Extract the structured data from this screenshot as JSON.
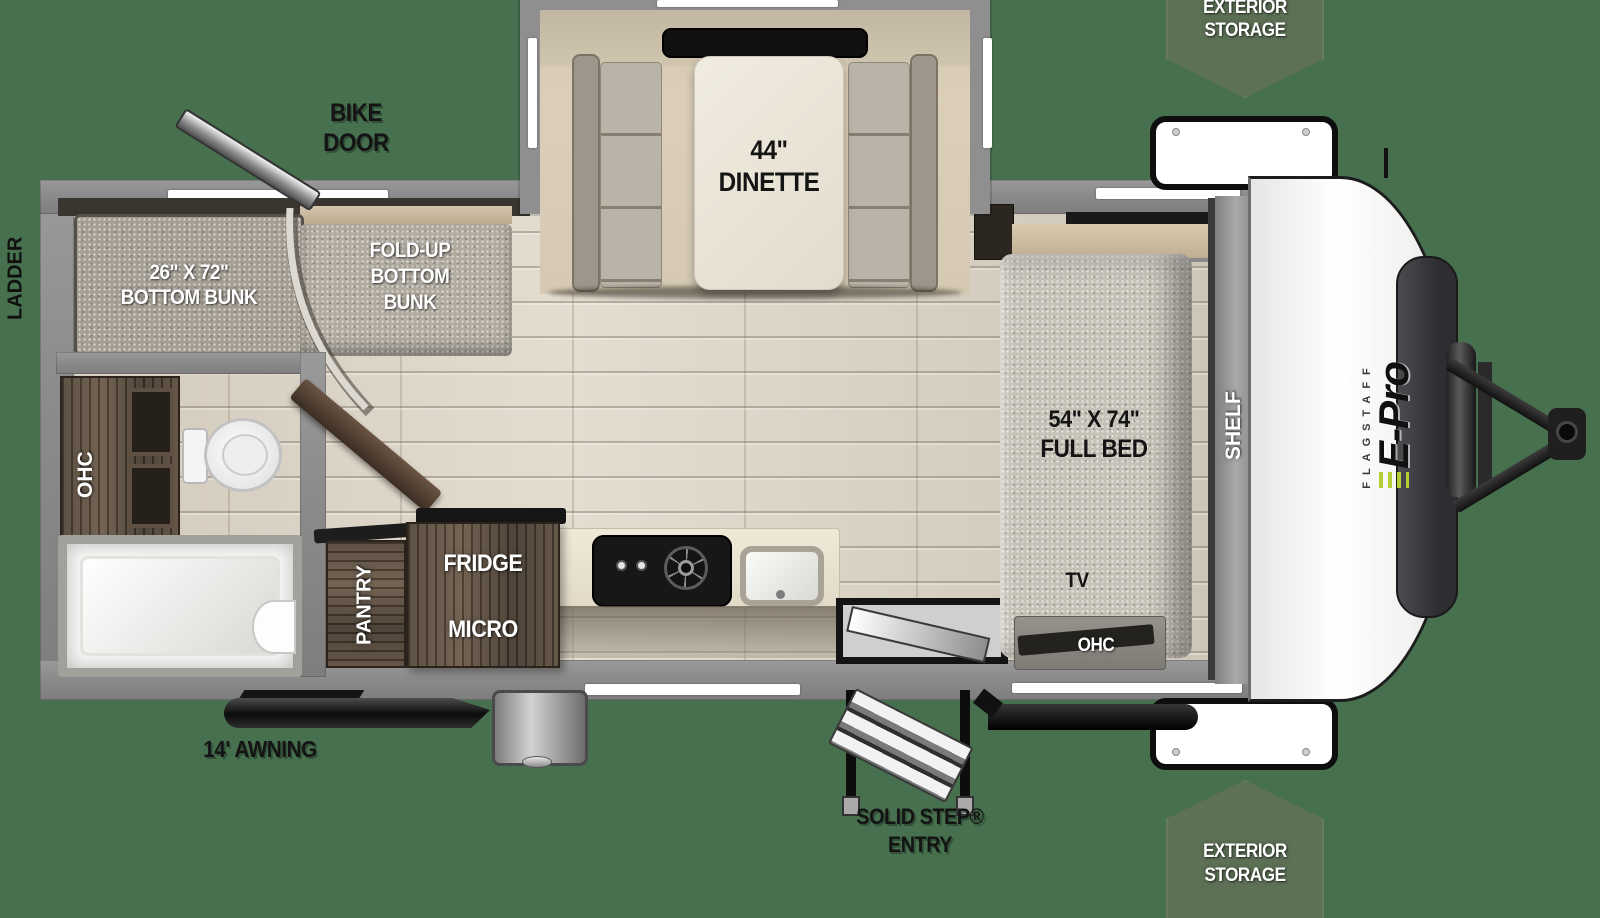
{
  "scene": {
    "background_color": "#47704f",
    "badge_color": "#5d7156",
    "accent_lime": "#b7cc35"
  },
  "badges": {
    "top": {
      "line1": "EXTERIOR",
      "line2": "STORAGE"
    },
    "bottom": {
      "line1": "EXTERIOR",
      "line2": "STORAGE"
    }
  },
  "exterior_labels": {
    "ladder": "LADDER",
    "bike_door_line1": "BIKE",
    "bike_door_line2": "DOOR",
    "awning": "14' AWNING",
    "entry_line1": "SOLID STEP®",
    "entry_line2": "ENTRY"
  },
  "interior_labels": {
    "dinette_line1": "44\"",
    "dinette_line2": "DINETTE",
    "bottom_bunk_line1": "26\" X 72\"",
    "bottom_bunk_line2": "BOTTOM BUNK",
    "foldup_line1": "FOLD-UP",
    "foldup_line2": "BOTTOM",
    "foldup_line3": "BUNK",
    "bath_ohc": "OHC",
    "pantry": "PANTRY",
    "fridge": "FRIDGE",
    "micro": "MICRO",
    "bed_line1": "54\" X 74\"",
    "bed_line2": "FULL BED",
    "tv": "TV",
    "bed_ohc": "OHC",
    "shelf": "SHELF"
  },
  "brand": {
    "flagstaff": "FLAGSTAFF",
    "model": "E-Pro"
  }
}
